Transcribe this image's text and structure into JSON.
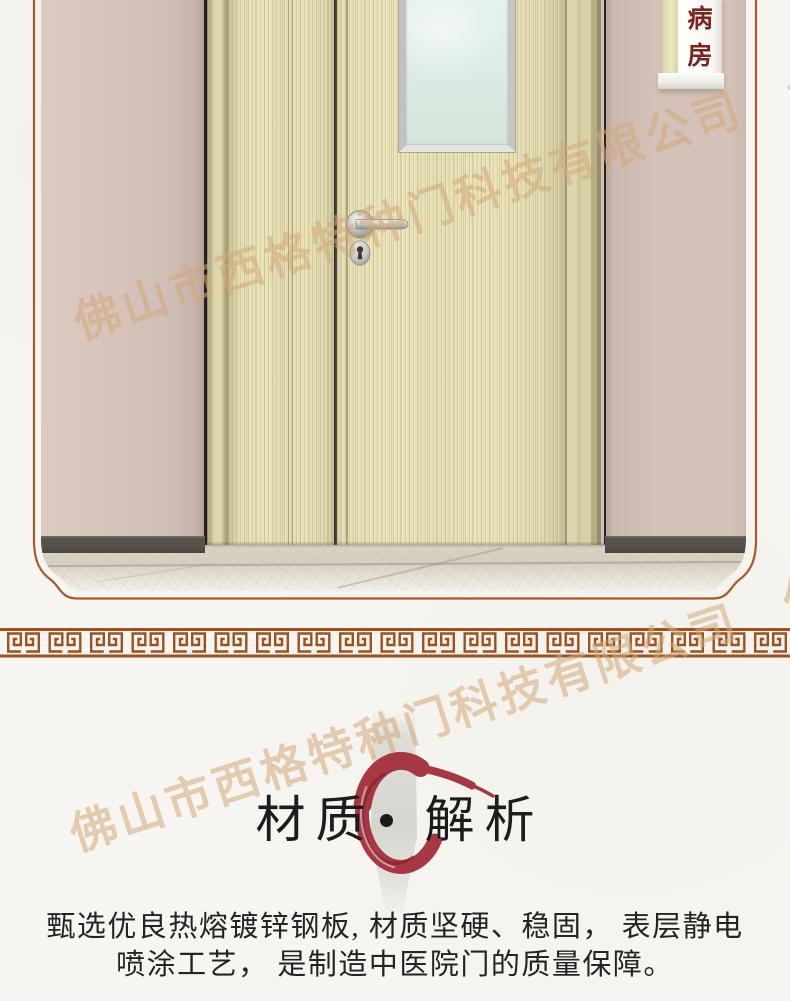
{
  "watermark": {
    "text": "佛山市西格特种门科技有限公司",
    "color": "#d2a878"
  },
  "door_scene": {
    "room_sign": {
      "char_top": "病",
      "char_bottom": "房",
      "text_color": "#7a231c"
    }
  },
  "divider": {
    "style": "greek-key-meander",
    "color": "#9b5220"
  },
  "material_section": {
    "title_left": "材质",
    "separator_dot": "•",
    "title_right": "解析",
    "enso_color": "#a63844",
    "description_line1": "甄选优良热熔镀锌钢板, 材质坚硬、稳固， 表层静电",
    "description_line2": "喷涂工艺， 是制造中医院门的质量保障。"
  },
  "colors": {
    "page_background": "#f6f5f1",
    "frame_border": "#a8582a",
    "wall": "#d4c2b9",
    "door_wood": "#e6dfb4",
    "window_glass": "#dcebe3",
    "baseboard": "#52504a",
    "floor_marble": "#d8d2c4"
  }
}
